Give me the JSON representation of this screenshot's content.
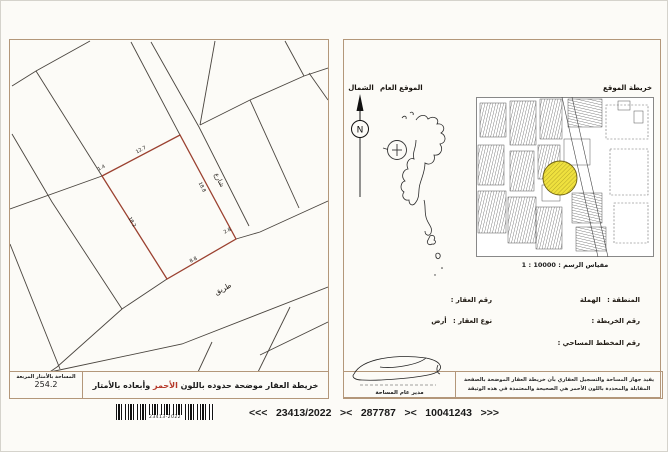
{
  "left_map": {
    "area_label": "المساحة بالأمتار المربعة",
    "area_value": "254.2",
    "caption_prefix": "خريطة العقار موضحة حدوده باللون",
    "caption_red_word": "الأحمر",
    "caption_suffix": "وأبعاده بالأمتار",
    "street_label": "شارع",
    "road_label": "طريق",
    "dims": {
      "corner_nw": "1.4",
      "top": "12.7",
      "street_side": "18.8",
      "corner_se": "2.8",
      "bottom": "8.8",
      "west_side": "18.2"
    }
  },
  "right_sheet": {
    "north_label": "الشمال",
    "compass_letter": "N",
    "general_location_label": "الموقع العام",
    "location_map_label": "خريطة الموقع",
    "scale_text": "مقياس الرسم : 10000 : 1",
    "fields": {
      "region_label": "المنطقة :",
      "region_value": "الهملة",
      "parcel_no_label": "رقم العقار :",
      "map_no_label": "رقم الخريطة :",
      "type_label": "نوع العقار :",
      "type_value": "أرض",
      "survey_plan_label": "رقم المخطط المساحي :"
    },
    "certification_line1": "يفيد جهاز المساحة والتسجيل العقاري بأن خريطة العقار الموضحة بالصفحة",
    "certification_line2": "المقابلة والمحددة باللون الأحمر هي الصحيحة والمعتمدة في هذه الوثيقة",
    "signature_title": "مدير عام المساحة"
  },
  "reference_strip": {
    "barcode_label": "23413-2022",
    "open_arrows": "<<<",
    "case_number": "23413/2022",
    "separator1": "><",
    "serial_number": "287787",
    "separator2": "><",
    "document_number": "10041243",
    "close_arrows": ">>>"
  },
  "colors": {
    "parcel_red": "#9b4130",
    "caption_red": "#b5392a",
    "highlight_yellow": "#efe13e",
    "panel_border": "#b3977a"
  }
}
